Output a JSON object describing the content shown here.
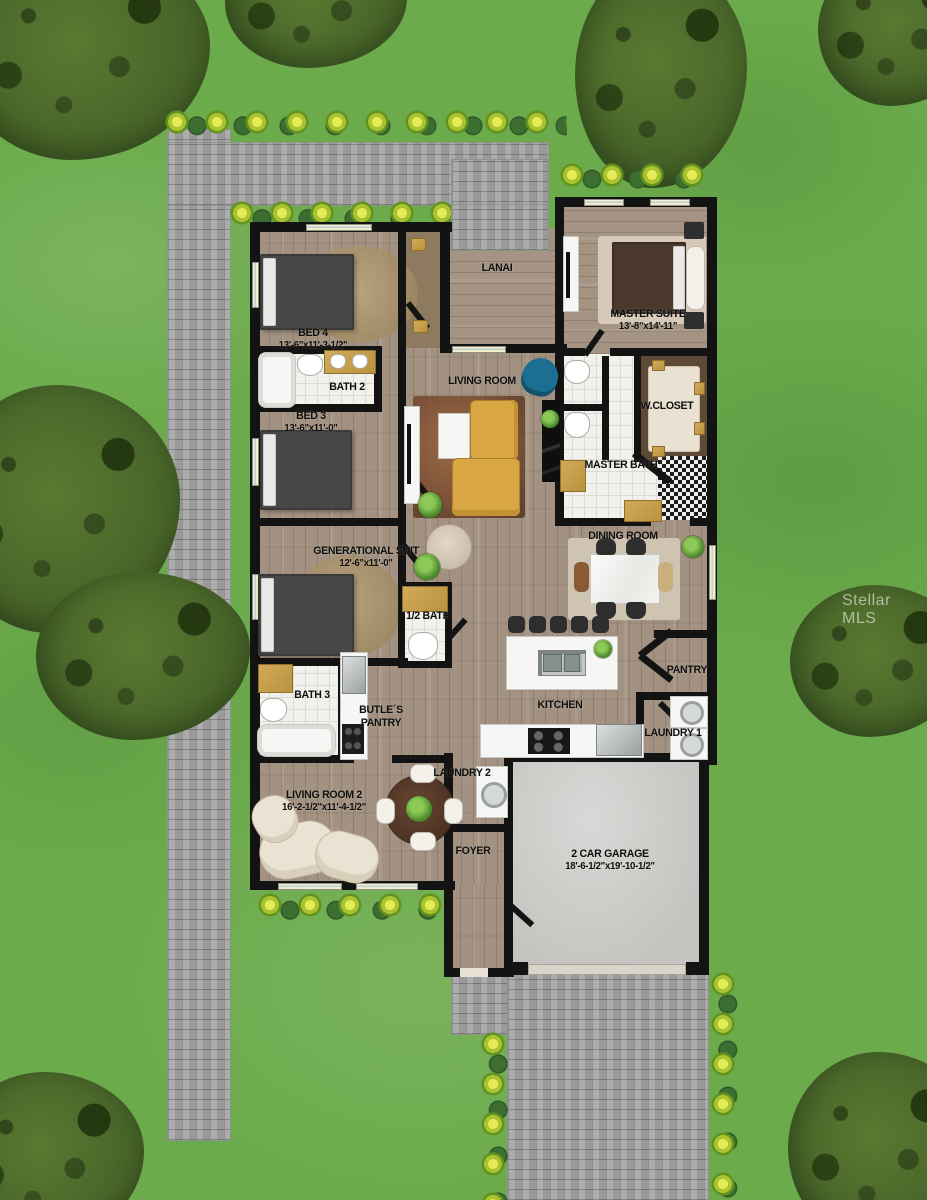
{
  "watermark": "Stellar MLS",
  "plan": {
    "rooms": [
      {
        "name": "LANAI",
        "dims": ""
      },
      {
        "name": "MASTER SUITE",
        "dims": "13'-8\"x14'-11\""
      },
      {
        "name": "BED 4",
        "dims": "13'-6\"x11'-3-1/2\""
      },
      {
        "name": "BATH 2",
        "dims": ""
      },
      {
        "name": "LIVING ROOM",
        "dims": ""
      },
      {
        "name": "BED 3",
        "dims": "13'-6\"x11'-0\""
      },
      {
        "name": "W.CLOSET",
        "dims": ""
      },
      {
        "name": "MASTER BATH",
        "dims": ""
      },
      {
        "name": "GENERATIONAL SUIT",
        "dims": "12'-6\"x11'-0\""
      },
      {
        "name": "DINING ROOM",
        "dims": ""
      },
      {
        "name": "1/2 BATH",
        "dims": ""
      },
      {
        "name": "BATH 3",
        "dims": ""
      },
      {
        "name": "BUTLE´S PANTRY",
        "dims": ""
      },
      {
        "name": "KITCHEN",
        "dims": ""
      },
      {
        "name": "PANTRY",
        "dims": ""
      },
      {
        "name": "LAUNDRY 1",
        "dims": ""
      },
      {
        "name": "LAUNDRY 2",
        "dims": ""
      },
      {
        "name": "LIVING ROOM 2",
        "dims": "16'-2-1/2\"x11'-4-1/2\""
      },
      {
        "name": "FOYER",
        "dims": ""
      },
      {
        "name": "2 CAR GARAGE",
        "dims": "18'-6-1/2\"x19'-10-1/2\""
      }
    ],
    "colors": {
      "grass": "#6cab4c",
      "paver": "#a3a3a3",
      "wall": "#131313",
      "wood_floor": "#a39282",
      "garage_floor": "#cdcdcb",
      "sofa_yellow": "#d9a844",
      "accent_chair_blue": "#1d6e93",
      "rug_master": "#d6c9ba"
    }
  }
}
